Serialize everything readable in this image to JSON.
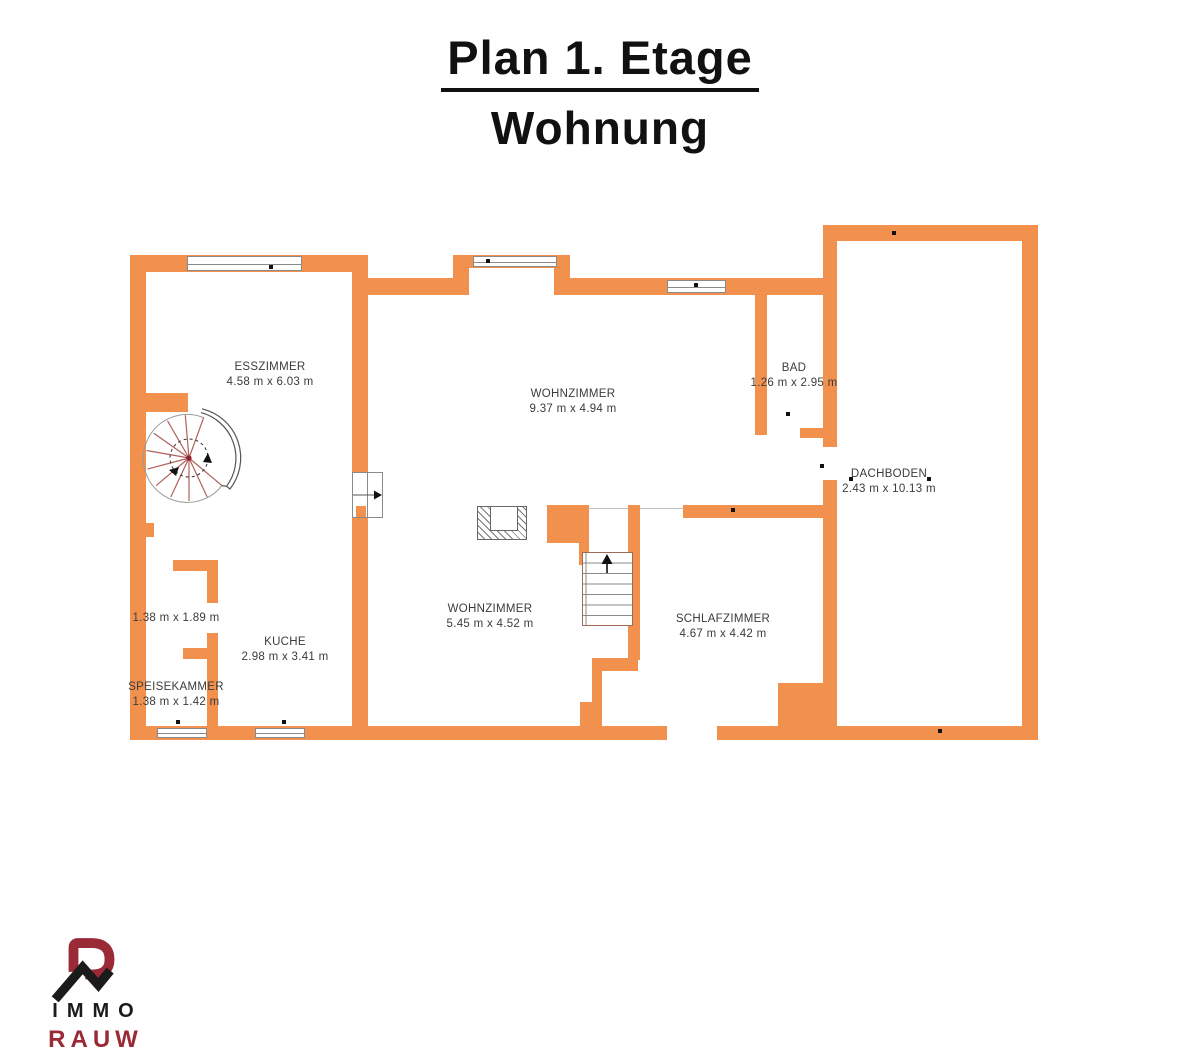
{
  "title": {
    "line1": "Plan 1. Etage",
    "line2": "Wohnung"
  },
  "rooms": [
    {
      "name": "ESSZIMMER",
      "dims": "4.58 m x 6.03 m"
    },
    {
      "name": "WOHNZIMMER",
      "dims": "9.37 m x 4.94 m"
    },
    {
      "name": "BAD",
      "dims": "1.26 m x 2.95 m"
    },
    {
      "name": "DACHBODEN",
      "dims": "2.43 m x 10.13 m"
    },
    {
      "name": "WOHNZIMMER",
      "dims": "5.45 m x 4.52 m"
    },
    {
      "name": "SCHLAFZIMMER",
      "dims": "4.67 m x 4.42 m"
    },
    {
      "name": "KUCHE",
      "dims": "2.98 m x 3.41 m"
    },
    {
      "name": "",
      "dims": "1.38 m x 1.89 m"
    },
    {
      "name": "SPEISEKAMMER",
      "dims": "1.38 m x 1.42 m"
    }
  ],
  "logo": {
    "brand_top": "IMMO",
    "brand_bottom": "RAUW"
  },
  "colors": {
    "wall": "#F2914E",
    "label_text": "#3b3b3b",
    "logo_red": "#9A2A35",
    "logo_black": "#1b1b1b"
  }
}
